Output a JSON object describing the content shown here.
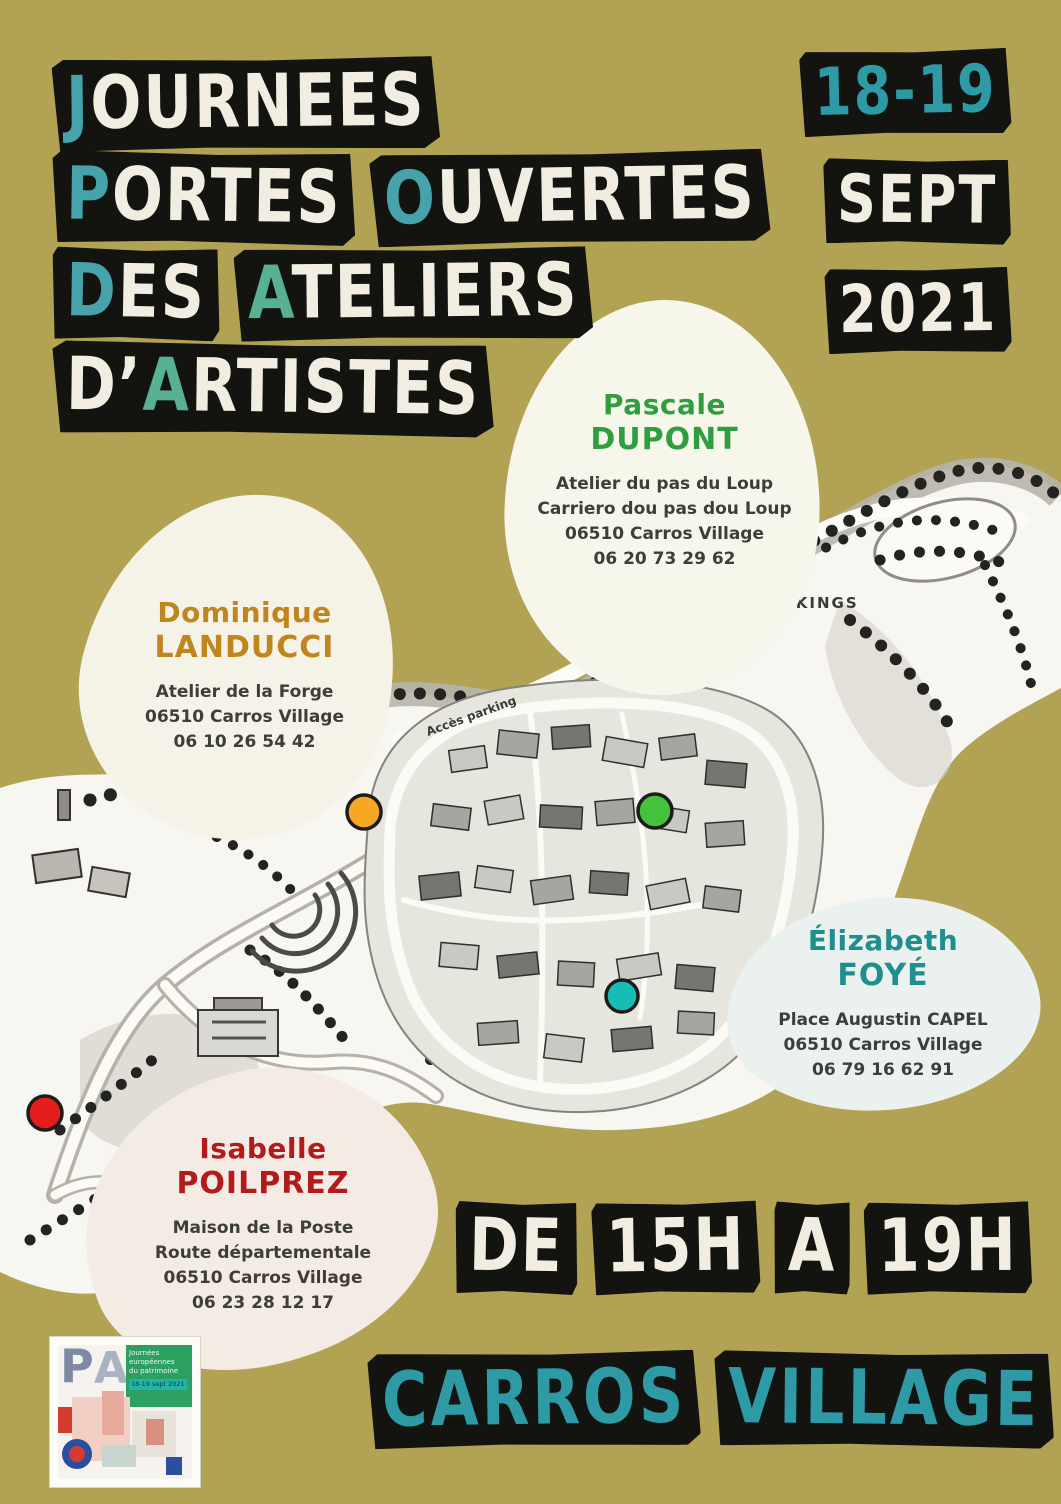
{
  "poster": {
    "background_color": "#b2a254",
    "black_block_color": "#13130f",
    "white_text_color": "#f1ede1",
    "teal_text_color": "#47a3ab",
    "green_text_color": "#57b192"
  },
  "title_blocks": [
    {
      "word": "JOURNEES",
      "segments": [
        {
          "t": "J",
          "c": "#47a3ab"
        },
        {
          "t": "OURNEES",
          "c": "#f1ede1"
        }
      ]
    },
    {
      "word": "PORTES",
      "segments": [
        {
          "t": "P",
          "c": "#47a3ab"
        },
        {
          "t": "ORTES",
          "c": "#f1ede1"
        }
      ]
    },
    {
      "word": "OUVERTES",
      "segments": [
        {
          "t": "O",
          "c": "#47a3ab"
        },
        {
          "t": "UVERTES",
          "c": "#f1ede1"
        }
      ]
    },
    {
      "word": "DES",
      "segments": [
        {
          "t": "D",
          "c": "#47a3ab"
        },
        {
          "t": "ES",
          "c": "#f1ede1"
        }
      ]
    },
    {
      "word": "ATELIERS",
      "segments": [
        {
          "t": "A",
          "c": "#57b192"
        },
        {
          "t": "TELIERS",
          "c": "#f1ede1"
        }
      ]
    },
    {
      "word": "D'ARTISTES",
      "segments": [
        {
          "t": "D’",
          "c": "#f1ede1"
        },
        {
          "t": "A",
          "c": "#57b192"
        },
        {
          "t": "RTISTES",
          "c": "#f1ede1"
        }
      ]
    }
  ],
  "dates_blocks": [
    {
      "t": "18-19",
      "c": "#2e9aa6"
    },
    {
      "t": "SEPT",
      "c": "#f1ede1"
    },
    {
      "t": "2021",
      "c": "#f1ede1"
    }
  ],
  "artists": [
    {
      "first": "Pascale",
      "last": "DUPONT",
      "name_color": "#2f9e41",
      "bubble_color": "#f7f6ea",
      "marker_color": "#44c23c",
      "lines": [
        "Atelier du pas du Loup",
        "Carriero dou pas dou Loup",
        "06510  Carros Village",
        "06 20 73 29 62"
      ]
    },
    {
      "first": "Dominique",
      "last": "LANDUCCI",
      "name_color": "#c0861d",
      "bubble_color": "#f5f3e8",
      "marker_color": "#f5a623",
      "lines": [
        "Atelier de la Forge",
        "06510  Carros Village",
        "06 10 26 54 42"
      ]
    },
    {
      "first": "Élizabeth",
      "last": "FOYÉ",
      "name_color": "#1f8e8e",
      "bubble_color": "#eaf1ee",
      "marker_color": "#17bdb4",
      "lines": [
        "Place Augustin CAPEL",
        "06510  Carros Village",
        "06 79 16 62 91"
      ]
    },
    {
      "first": "Isabelle",
      "last": "POILPREZ",
      "name_color": "#b31b1b",
      "bubble_color": "#f4ebe5",
      "marker_color": "#e51c1c",
      "lines": [
        "Maison de la Poste",
        "Route départementale",
        "06510 Carros Village",
        "06 23 28 12 17"
      ]
    }
  ],
  "schedule_blocks": [
    {
      "t": "DE",
      "c": "#f1ede1"
    },
    {
      "t": "15H",
      "c": "#f1ede1"
    },
    {
      "t": "A",
      "c": "#f1ede1"
    },
    {
      "t": "19H",
      "c": "#f1ede1"
    }
  ],
  "location_blocks": [
    {
      "t": "CARROS",
      "c": "#2e9aa6"
    },
    {
      "t": "VILLAGE",
      "c": "#2e9aa6"
    }
  ],
  "map": {
    "labels": {
      "parkings": "PARKINGS",
      "access": "Accès parking"
    }
  },
  "logo": {
    "letter_p": "P",
    "letter_a": "A",
    "badge_line1": "Journées",
    "badge_line2": "européennes",
    "badge_line3": "du patrimoine",
    "badge_dates": "18-19 sept 2021"
  }
}
